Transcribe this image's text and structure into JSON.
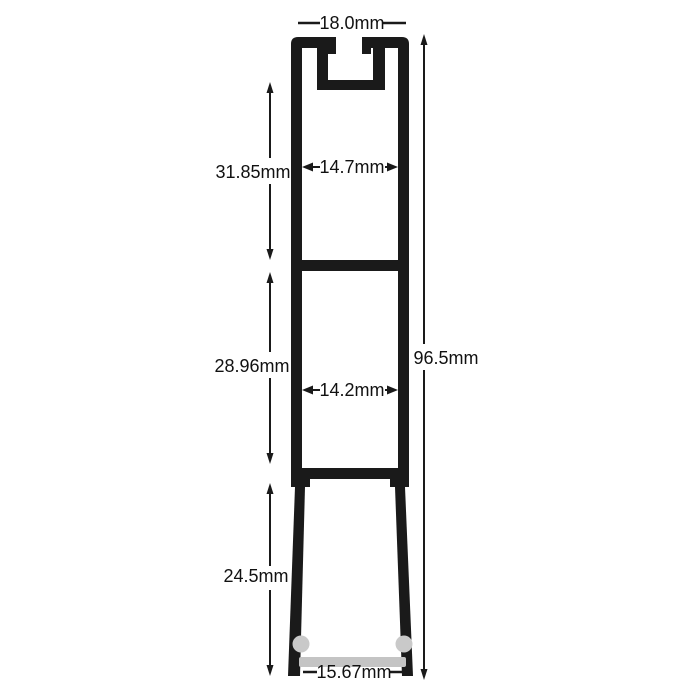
{
  "diagram": {
    "type": "technical-cross-section",
    "dimensions": {
      "overall_width": "18.0mm",
      "top_inner_width": "14.7mm",
      "top_section_height": "31.85mm",
      "middle_section_height": "28.96mm",
      "middle_inner_width": "14.2mm",
      "overall_height": "96.5mm",
      "bottom_section_height": "24.5mm",
      "bottom_inner_width": "15.67mm"
    },
    "colors": {
      "profile": "#1a1a1a",
      "diffuser_bar": "#c4c4c4",
      "diffuser_endcap": "#c9c9c9",
      "dimension_text": "#111111",
      "background": "#ffffff"
    }
  }
}
